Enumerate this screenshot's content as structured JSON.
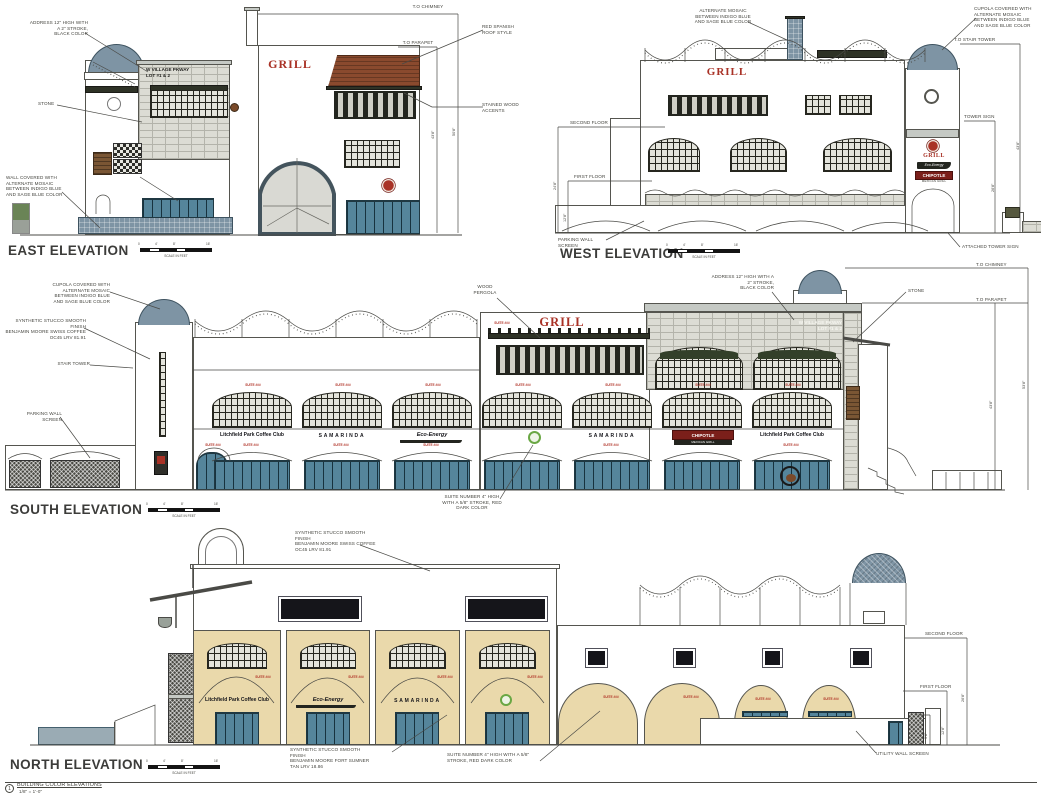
{
  "sheet": {
    "note_number": "1",
    "note_title": "BUILDING COLOR ELEVATIONS",
    "note_scale": "1/8\" = 1'-0\"",
    "scale_caption": "SCALE IN FEET",
    "scale_ticks": [
      "0",
      "4'",
      "8'",
      "16'"
    ]
  },
  "palette": {
    "cupola_blue": "#7e94a4",
    "roof_red": "#8a4a2e",
    "grill_red": "#a93226",
    "suite_red": "#b03226",
    "storefront_teal": "#55859b",
    "stucco_tan": "#ead9ab",
    "stone_grey": "#dcdcd4",
    "chipotle_red": "#7b1f1a",
    "logo_green": "#6aa744"
  },
  "east": {
    "title": "EAST ELEVATION",
    "grill_sign": "GRILL",
    "address_sign": "W VILLAGE PKWAY\nLOT #1 & 2",
    "ann": {
      "address": "ADDRESS 12\" HIGH WITH\nA 2\" STROKE,\nBLACK COLOR",
      "stone": "STONE",
      "wall_mosaic": "WALL COVERED WITH\nALTERNATE MOSAIC\nBETWEEN INDIGO BLUE\nAND SAGE BLUE COLOR",
      "to_chimney": "T.O CHIMNEY",
      "red_roof": "RED SPANISH\nROOF STYLE",
      "to_parapet": "T.O PARAPET",
      "stained_wood": "STAINED WOOD\nACCENTS"
    },
    "dims": {
      "parapet": "43'8\"",
      "chimney": "50'8\""
    }
  },
  "west": {
    "title": "WEST ELEVATION",
    "grill_sign": "GRILL",
    "tower": {
      "grill": "GRILL",
      "eco": "Eco-Energy",
      "chipotle": "CHIPOTLE",
      "chipotle_sub": "MEXICAN GRILL"
    },
    "ann": {
      "alt_mosaic": "ALTERNATE MOSAIC\nBETWEEN INDIGO BLUE\nAND SAGE BLUE COLOR",
      "cupola": "CUPOLA COVERED WITH\nALTERNATE MOSAIC\nBETWEEN INDIGO BLUE\nAND SAGE BLUE COLOR",
      "to_stair_tower": "T.O STAIR TOWER",
      "tower_sign": "TOWER SIGN",
      "second_floor": "SECOND FLOOR",
      "first_floor": "FIRST FLOOR",
      "parking_wall": "PARKING WALL SCREEN",
      "attached_tower_sign": "ATTACHED TOWER SIGN"
    },
    "dims": {
      "stair_tower": "43'8\"",
      "tower_sign": "26'8\"",
      "second": "24'8\"",
      "first": "12'8\""
    }
  },
  "south": {
    "title": "SOUTH ELEVATION",
    "grill_sign": "GRILL",
    "address_sign": "W VILLAGE PKWAY\nLOT #1 & 2",
    "suite_label": "SUITE ###",
    "tenants": [
      "Litchfield Park Coffee Club",
      "SAMARINDA",
      "Eco-Energy",
      "SAMARINDA",
      "CHIPOTLE",
      "Litchfield Park Coffee Club"
    ],
    "chipotle_sub": "MEXICAN GRILL",
    "ann": {
      "cupola": "CUPOLA COVERED WITH\nALTERNATE MOSAIC\nBETWEEN INDIGO BLUE\nAND SAGE BLUE COLOR",
      "stucco_swiss": "SYNTHETIC STUCCO SMOOTH FINISH\nBENJAMIN MOORE SWISS COFFEE\nOC45 LRV 81.91",
      "stair_tower": "STAIR TOWER",
      "parking_wall": "PARKING WALL SCREEN",
      "wood_pergola": "WOOD\nPERGOLA",
      "address": "ADDRESS 12\" HIGH WITH A\n2\" STROKE,\nBLACK COLOR",
      "stone": "STONE",
      "to_chimney": "T.O CHIMNEY",
      "to_parapet": "T.O PARAPET",
      "suite_note": "SUITE NUMBER 4\" HIGH\nWITH A 5/8\" STROKE, RED\nDARK COLOR"
    },
    "dims": {
      "parapet": "43'8\"",
      "chimney": "53'8\""
    }
  },
  "north": {
    "title": "NORTH ELEVATION",
    "tenants": [
      "Litchfield Park Coffee Club",
      "Eco-Energy",
      "SAMARINDA"
    ],
    "suite_label": "SUITE ###",
    "ann": {
      "stucco_swiss": "SYNTHETIC STUCCO SMOOTH FINISH\nBENJAMIN MOORE SWISS COFFEE\nOC45 LRV 81.91",
      "stucco_tan": "SYNTHETIC STUCCO SMOOTH FINISH\nBENJAMIN MOORE FORT SUMNER\nTAN LRV 18.86",
      "suite_note": "SUITE NUMBER 4\" HIGH WITH A 5/8\"\nSTROKE, RED DARK COLOR",
      "second_floor": "SECOND FLOOR",
      "first_floor": "FIRST FLOOR",
      "utility": "UTILITY WALL SCREEN"
    },
    "dims": {
      "second": "26'8\"",
      "first": "12'8\"",
      "screen": "9'8\""
    }
  }
}
